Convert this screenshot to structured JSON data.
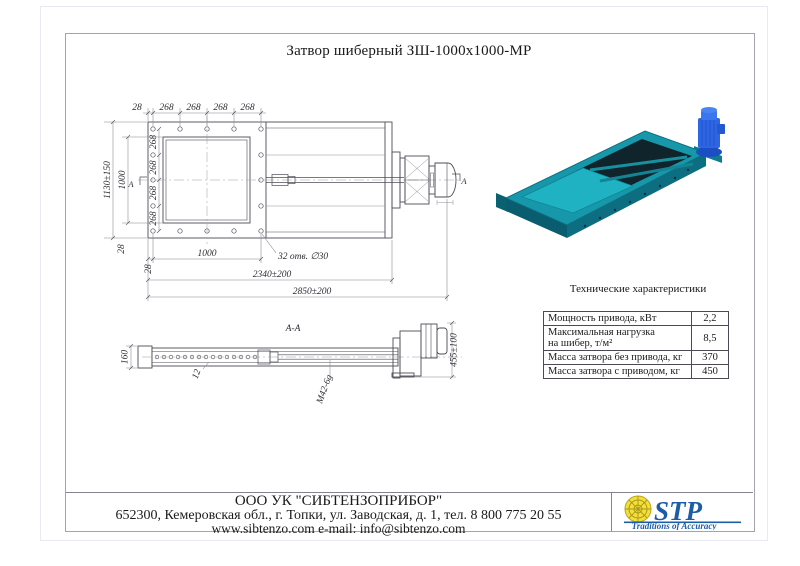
{
  "page": {
    "title": "Затвор шиберный ЗШ-1000х1000-МР"
  },
  "drawing": {
    "top_view": {
      "top_chain": [
        "28",
        "268",
        "268",
        "268",
        "268"
      ],
      "height_total": "1130±150",
      "opening_height": "1000",
      "col_chain": [
        "268",
        "268",
        "268",
        "268"
      ],
      "col_margin": "28",
      "bottom_margin": "28",
      "opening_width": "1000",
      "holes_note": "32 отв. ∅30",
      "length_working": "2340±200",
      "length_total": "2850±200",
      "view_label": "А"
    },
    "section_view": {
      "label": "А-А",
      "height": "160",
      "plate": "12",
      "thread": "М42-6g",
      "stroke_dim": "455±100"
    }
  },
  "specs": {
    "title": "Технические характеристики",
    "rows": [
      {
        "name": "Мощность привода, кВт",
        "value": "2,2"
      },
      {
        "name": "Максимальная нагрузка\nна шибер, т/м²",
        "value": "8,5"
      },
      {
        "name": "Масса затвора без привода, кг",
        "value": "370"
      },
      {
        "name": "Масса затвора с приводом, кг",
        "value": "450"
      }
    ]
  },
  "footer": {
    "company": "ООО УК \"СИБТЕНЗОПРИБОР\"",
    "address": "652300, Кемеровская обл., г. Топки, ул. Заводская, д. 1, тел. 8 800 775 20 55",
    "web": "www.sibtenzo.com e-mail: info@sibtenzo.com",
    "logo": {
      "text": "STP",
      "tagline": "Traditions of Accuracy"
    }
  },
  "colors": {
    "stp_blue": "#1d5ca6",
    "stp_yellow": "#f2e03a",
    "product_teal": "#1798aa",
    "motor_blue": "#2c66e2"
  }
}
